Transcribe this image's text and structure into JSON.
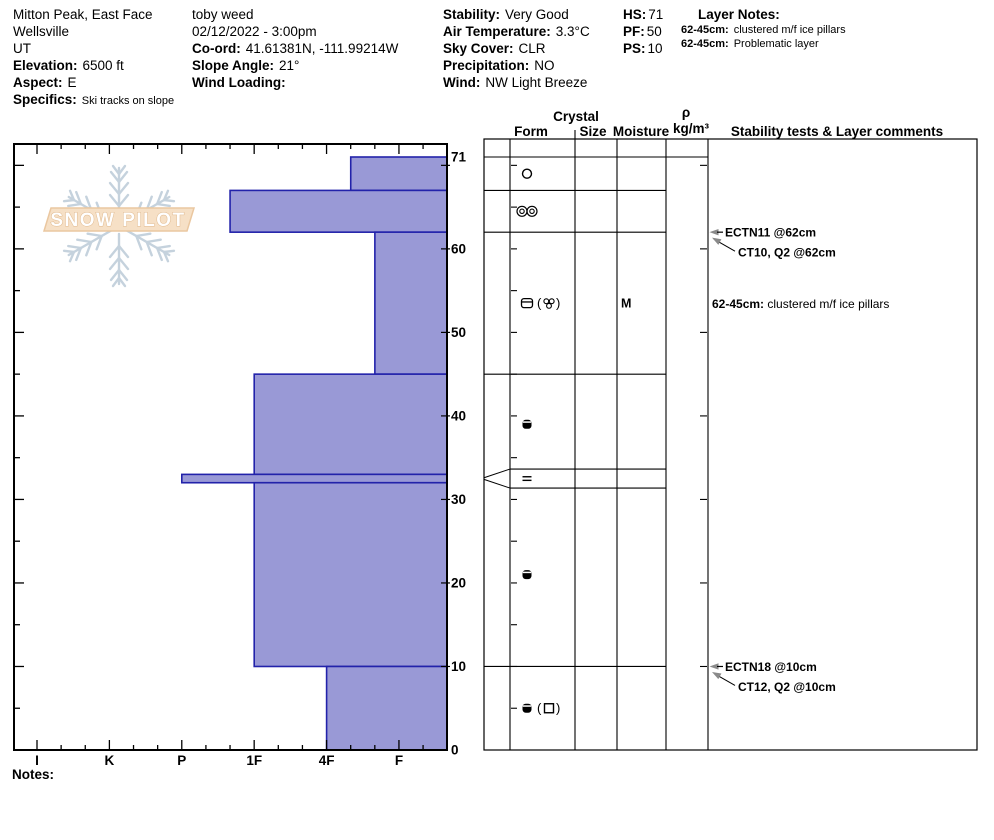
{
  "header": {
    "columns": [
      {
        "name": "location",
        "x": 13,
        "lines": [
          {
            "label": "",
            "value": "Mitton Peak, East Face"
          },
          {
            "label": "",
            "value": "Wellsville"
          },
          {
            "label": "",
            "value": "UT"
          },
          {
            "label": "Elevation:",
            "value": "6500 ft"
          },
          {
            "label": "Aspect:",
            "value": "E"
          },
          {
            "label": "Specifics:",
            "value": "Ski tracks on slope",
            "small_value": true
          }
        ]
      },
      {
        "name": "observer",
        "x": 192,
        "lines": [
          {
            "label": "",
            "value": "toby weed"
          },
          {
            "label": "",
            "value": "02/12/2022 - 3:00pm"
          },
          {
            "label": "Co-ord:",
            "value": "41.61381N, -111.99214W"
          },
          {
            "label": "Slope Angle:",
            "value": "21°"
          },
          {
            "label": "Wind Loading:",
            "value": ""
          }
        ]
      },
      {
        "name": "conditions",
        "x": 443,
        "lines": [
          {
            "label": "Stability:",
            "value": "Very Good"
          },
          {
            "label": "Air Temperature:",
            "value": "3.3°C"
          },
          {
            "label": "Sky Cover:",
            "value": "CLR"
          },
          {
            "label": "Precipitation:",
            "value": "NO"
          },
          {
            "label": "Wind:",
            "value": "NW Light Breeze"
          }
        ]
      },
      {
        "name": "snowpack-summary",
        "x": 623,
        "lines": [
          {
            "label": "HS:",
            "value": "71",
            "tight": true
          },
          {
            "label": "PF:",
            "value": "50",
            "tight": true
          },
          {
            "label": "PS:",
            "value": "10",
            "tight": true
          }
        ]
      },
      {
        "name": "layer-notes",
        "x": 681,
        "lines": [
          {
            "label": "Layer Notes:",
            "value": "",
            "heading": true
          },
          {
            "label": "62-45cm:",
            "value": "clustered m/f ice pillars",
            "small": true
          },
          {
            "label": "62-45cm:",
            "value": "Problematic layer",
            "small": true
          }
        ]
      }
    ]
  },
  "logo": {
    "text": "SNOW PILOT"
  },
  "chart_data": {
    "type": "bar",
    "subtype": "snow-hardness-profile",
    "title": "Snow profile hardness vs height",
    "depth_axis": {
      "unit": "cm",
      "min": 0,
      "max": 71,
      "labels": [
        71,
        60,
        50,
        40,
        30,
        20,
        10,
        0
      ]
    },
    "hardness_axis": {
      "categories": [
        "I",
        "K",
        "P",
        "1F",
        "4F",
        "F"
      ]
    },
    "layers": [
      {
        "top_cm": 71,
        "bottom_cm": 67,
        "hardness": "4F-",
        "form_primary": "circle-open",
        "form_secondary": null,
        "moisture": ""
      },
      {
        "top_cm": 67,
        "bottom_cm": 62,
        "hardness": "1F+",
        "form_primary": "double-circle-pair",
        "form_secondary": null,
        "moisture": ""
      },
      {
        "top_cm": 62,
        "bottom_cm": 45,
        "hardness": "F+",
        "form_primary": "crust",
        "form_secondary": "cluster",
        "moisture": "M",
        "comment_label": "62-45cm:",
        "comment": " clustered m/f ice pillars"
      },
      {
        "top_cm": 45,
        "bottom_cm": 33,
        "hardness": "1F",
        "form_primary": "melt-dot",
        "form_secondary": null,
        "moisture": ""
      },
      {
        "top_cm": 33,
        "bottom_cm": 32,
        "hardness": "P",
        "form_primary": "ice-lens",
        "form_secondary": null,
        "moisture": "",
        "thin": true
      },
      {
        "top_cm": 32,
        "bottom_cm": 10,
        "hardness": "1F",
        "form_primary": "melt-dot",
        "form_secondary": null,
        "moisture": ""
      },
      {
        "top_cm": 10,
        "bottom_cm": 0,
        "hardness": "4F",
        "form_primary": "melt-dot",
        "form_secondary": "square-open",
        "moisture": ""
      }
    ],
    "stability_tests": [
      {
        "text": "ECTN11 @62cm",
        "height_cm": 62,
        "style": "primary"
      },
      {
        "text": "CT10, Q2 @62cm",
        "height_cm": 62,
        "style": "secondary"
      },
      {
        "text": "ECTN18 @10cm",
        "height_cm": 10,
        "style": "primary"
      },
      {
        "text": "CT12, Q2 @10cm",
        "height_cm": 10,
        "style": "secondary"
      }
    ]
  },
  "table": {
    "headers": {
      "crystal": "Crystal",
      "form": "Form",
      "size": "Size",
      "moisture": "Moisture",
      "density_rho": "ρ",
      "density_unit": "kg/m³",
      "comments": "Stability tests & Layer comments"
    }
  },
  "notes_label": "Notes:",
  "colors": {
    "bar_fill": "#9999d6",
    "bar_stroke": "#2222aa",
    "line": "#000000",
    "logo_snowflake": "#c5d2dd",
    "logo_banner_fill": "#f6e0c6",
    "logo_banner_stroke": "#eac7a0",
    "logo_text_stroke": "#e0b98e",
    "arrow_gray": "#8a8a8a"
  }
}
